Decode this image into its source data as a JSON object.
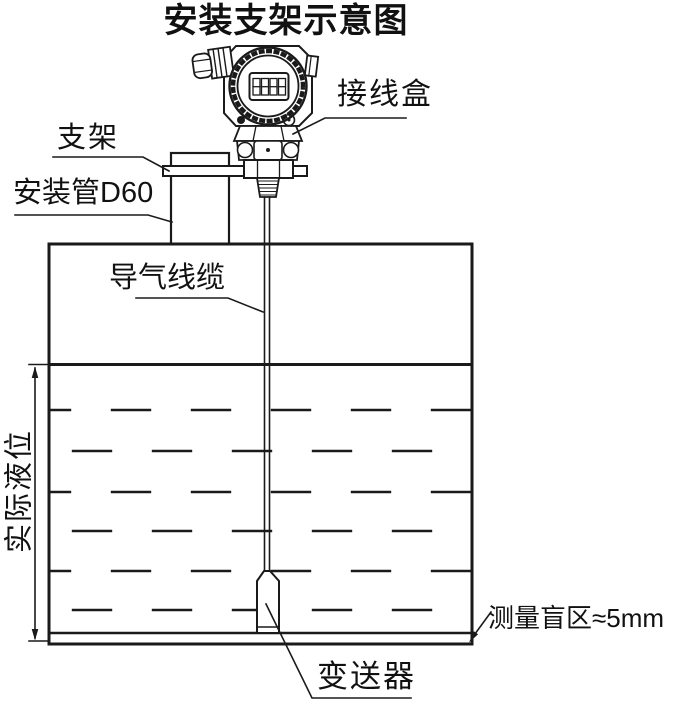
{
  "title": "安装支架示意图",
  "labels": {
    "junction_box": "接线盒",
    "bracket": "支架",
    "mounting_pipe": "安装管D60",
    "air_cable": "导气线缆",
    "actual_level": "实际液位",
    "blind_zone": "测量盲区≈5mm",
    "transmitter": "变送器"
  },
  "device": {
    "lcd_digits": "8888"
  },
  "colors": {
    "line": "#1a1a1a",
    "background": "#ffffff"
  }
}
